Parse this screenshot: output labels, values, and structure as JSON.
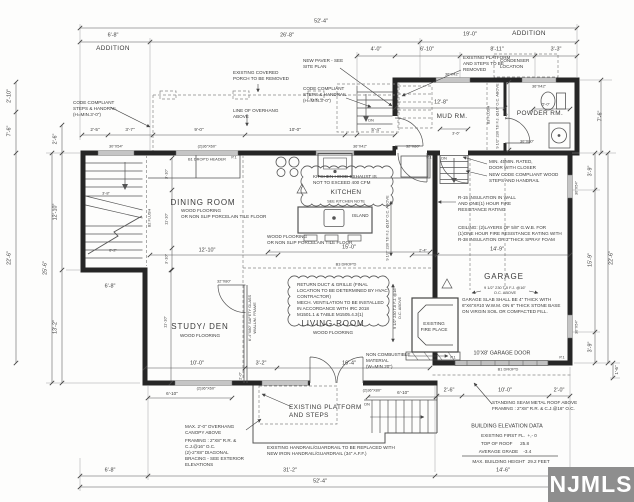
{
  "watermark": {
    "text": "NJMLS"
  },
  "annotations": [
    {
      "n": "dim-overall-top",
      "t": "52'-4\"",
      "x": 321,
      "y": 22,
      "s": 5
    },
    {
      "n": "dim-addition-left-width",
      "t": "6'-8\"",
      "x": 113,
      "y": 36,
      "s": 5
    },
    {
      "n": "label-addition-left",
      "t": "ADDITION",
      "x": 113,
      "y": 49,
      "s": 6
    },
    {
      "n": "dim-main-top",
      "t": "26'-8\"",
      "x": 287,
      "y": 36,
      "s": 5
    },
    {
      "n": "dim-addition-right-width",
      "t": "19'-0\"",
      "x": 470,
      "y": 35,
      "s": 5
    },
    {
      "n": "label-addition-right",
      "t": "ADDITION",
      "x": 529,
      "y": 34,
      "s": 6
    },
    {
      "n": "dim-4-0",
      "t": "4'-0\"",
      "x": 376,
      "y": 50,
      "s": 5
    },
    {
      "n": "dim-6-10-addition",
      "t": "6'-10\"",
      "x": 427,
      "y": 50,
      "s": 5
    },
    {
      "n": "dim-8-11",
      "t": "8'-11\"",
      "x": 497,
      "y": 50,
      "s": 5
    },
    {
      "n": "dim-3-3",
      "t": "3'-3\"",
      "x": 556,
      "y": 50,
      "s": 5
    },
    {
      "n": "note-new-paver",
      "t": "NEW PAVER - SEE\nSITE PLAN",
      "x": 303,
      "y": 58,
      "s": 4,
      "a": "tl"
    },
    {
      "n": "note-platform-steps-removed",
      "t": "EXISTING PLATFORM\nAND STEPS TO BE\nREMOVED",
      "x": 463,
      "y": 55,
      "s": 4,
      "a": "tl"
    },
    {
      "n": "note-condenser-location",
      "t": "CONDENSER\nLOCATION",
      "x": 500,
      "y": 58,
      "s": 4,
      "a": "tl"
    },
    {
      "n": "note-covered-porch-removed",
      "t": "EXISTING COVERED\nPORCH TO BE REMOVED",
      "x": 233,
      "y": 70,
      "s": 4,
      "a": "tl"
    },
    {
      "n": "note-code-steps-top",
      "t": "CODE COMPLIANT\nSTEPS & HANDRAIL\n(H=MIN.3'-0\")",
      "x": 303,
      "y": 86,
      "s": 4,
      "a": "tl"
    },
    {
      "n": "note-line-overhang",
      "t": "LINE OF OVERHANG\nABOVE",
      "x": 233,
      "y": 108,
      "s": 4,
      "a": "tl"
    },
    {
      "n": "note-code-steps-left",
      "t": "CODE COMPLIANT\nSTEPS & HANDRAIL\n(H=MIN.3'-0\")",
      "x": 73,
      "y": 100,
      "s": 4,
      "a": "tl"
    },
    {
      "n": "dim-2-5",
      "t": "2'-5\"",
      "x": 95,
      "y": 130,
      "s": 4
    },
    {
      "n": "dim-3-7",
      "t": "3'-7\"",
      "x": 130,
      "y": 130,
      "s": 4
    },
    {
      "n": "dim-9-0",
      "t": "9'-0\"",
      "x": 199,
      "y": 130,
      "s": 4
    },
    {
      "n": "dim-10-0-porch",
      "t": "10'-0\"",
      "x": 295,
      "y": 130,
      "s": 4
    },
    {
      "n": "dim-5-4",
      "t": "5'-4\"",
      "x": 376,
      "y": 130,
      "s": 4
    },
    {
      "n": "win-30x54-stairs",
      "t": "30\"X54\"",
      "x": 116,
      "y": 146,
      "s": 3
    },
    {
      "n": "win-2-36x60-dining",
      "t": "(2)36\"X60\"",
      "x": 207,
      "y": 146,
      "s": 3
    },
    {
      "n": "hdr-b1-dropd-header",
      "t": "B1 DROP'D HEADER",
      "x": 207,
      "y": 159,
      "s": 3
    },
    {
      "n": "win-36x42-kitchen",
      "t": "36\"X42\"",
      "x": 360,
      "y": 146,
      "s": 3
    },
    {
      "n": "door-32x80-kitchen",
      "t": "32\"X80\"",
      "x": 413,
      "y": 146,
      "s": 3
    },
    {
      "n": "win-36x42-mud",
      "t": "36\"X42\"",
      "x": 452,
      "y": 74,
      "s": 3
    },
    {
      "n": "win-36x42-powder",
      "t": "36\"X42\"",
      "x": 539,
      "y": 86,
      "s": 3
    },
    {
      "n": "dim-5-0-powder",
      "t": "5'-0\"",
      "x": 546,
      "y": 104,
      "s": 3
    },
    {
      "n": "room-powder",
      "t": "POWDER RM.",
      "x": 540,
      "y": 114,
      "s": 6
    },
    {
      "n": "door-30x80-powder",
      "t": "30\"X80\"",
      "x": 527,
      "y": 141,
      "s": 3
    },
    {
      "n": "dim-12-8-mud",
      "t": "12'-8\"",
      "x": 441,
      "y": 103,
      "s": 5
    },
    {
      "n": "room-mud",
      "t": "MUD RM.",
      "x": 452,
      "y": 117,
      "s": 6
    },
    {
      "n": "dim-7-6-addition-right",
      "t": "7'-6\"",
      "x": 601,
      "y": 116,
      "s": 5,
      "r": 1
    },
    {
      "n": "dim-3-6-mud-stairs",
      "t": "3'-6\"",
      "x": 456,
      "y": 133,
      "s": 3
    },
    {
      "n": "note-b3-flush",
      "t": "B3 FLUSH",
      "x": 488,
      "y": 115,
      "s": 3,
      "r": 1
    },
    {
      "n": "note-tji-mud",
      "t": "9 1/2\" 230 TJI F.J. @16\" O.C. ABOVE",
      "x": 497,
      "y": 116,
      "s": 3,
      "r": 1
    },
    {
      "n": "dim-7-0-powder",
      "t": "7'-0\"",
      "x": 506,
      "y": 116,
      "s": 3,
      "r": 1
    },
    {
      "n": "dn-mud-stairs",
      "t": "DN",
      "x": 444,
      "y": 158,
      "s": 3
    },
    {
      "n": "room-dining",
      "t": "DINING ROOM",
      "x": 203,
      "y": 203,
      "s": 7
    },
    {
      "n": "floor-dining",
      "t": "WOOD FLOORING\nOR NON SLIP PORCELAIN TILE FLOOR",
      "x": 181,
      "y": 208,
      "s": 4,
      "a": "tl"
    },
    {
      "n": "dim-3-10-a",
      "t": "3'-10\"",
      "x": 166,
      "y": 174,
      "s": 3,
      "r": 1
    },
    {
      "n": "dim-11-10-dining",
      "t": "11'-10\"",
      "x": 166,
      "y": 219,
      "s": 3,
      "r": 1
    },
    {
      "n": "dim-3-10-b",
      "t": "3'-10\"",
      "x": 166,
      "y": 259,
      "s": 3,
      "r": 1
    },
    {
      "n": "dim-3-8-stairs",
      "t": "3'-8\"",
      "x": 106,
      "y": 193,
      "s": 3
    },
    {
      "n": "dim-6-2-stairs",
      "t": "6'-2\"",
      "x": 113,
      "y": 250,
      "s": 3
    },
    {
      "n": "dim-6-8-stairs",
      "t": "6'-8\"",
      "x": 110,
      "y": 287,
      "s": 5
    },
    {
      "n": "dim-12-10-stairhall",
      "t": "12'-10\"",
      "x": 56,
      "y": 212,
      "s": 5,
      "r": 1
    },
    {
      "n": "dim-25-6-left",
      "t": "25'-6\"",
      "x": 46,
      "y": 268,
      "s": 5,
      "r": 1
    },
    {
      "n": "dim-13-2-left",
      "t": "13'-2\"",
      "x": 56,
      "y": 327,
      "s": 5,
      "r": 1
    },
    {
      "n": "dim-22-6-left",
      "t": "22'-6\"",
      "x": 10,
      "y": 258,
      "s": 5,
      "r": 1
    },
    {
      "n": "dim-2-10-left",
      "t": "2'-10\"",
      "x": 10,
      "y": 96,
      "s": 5,
      "r": 1
    },
    {
      "n": "dim-7-6-left",
      "t": "7'-6\"",
      "x": 10,
      "y": 131,
      "s": 5,
      "r": 1
    },
    {
      "n": "dim-2-6-left",
      "t": "2'-6\"",
      "x": 56,
      "y": 139,
      "s": 5,
      "r": 1
    },
    {
      "n": "note-b2-flush",
      "t": "B2 FLUSH",
      "x": 149,
      "y": 218,
      "s": 3,
      "r": 1
    },
    {
      "n": "cloud-kitchen-hood",
      "t": "KITCHEN HOOD EXHAUST IS\nNOT TO EXCEED 400 CFM",
      "x": 313,
      "y": 174,
      "s": 4,
      "a": "tl"
    },
    {
      "n": "room-kitchen",
      "t": "KITCHEN",
      "x": 346,
      "y": 193,
      "s": 6
    },
    {
      "n": "note-see-kitchen",
      "t": "SEE KITCHEN NOTE",
      "x": 346,
      "y": 201,
      "s": 3
    },
    {
      "n": "label-island",
      "t": "ISLAND",
      "x": 352,
      "y": 216,
      "s": 4,
      "a": "lm"
    },
    {
      "n": "floor-kitchen",
      "t": "WOOD FLOORING\nOR NON SLIP PORCELAIN TILE FLOOR",
      "x": 267,
      "y": 234,
      "s": 4,
      "a": "tl"
    },
    {
      "n": "dim-15-0-kitchen",
      "t": "15'-0\"",
      "x": 349,
      "y": 248,
      "s": 5
    },
    {
      "n": "note-b3-dropd",
      "t": "B3 DROP'D",
      "x": 346,
      "y": 264,
      "s": 3
    },
    {
      "n": "note-tji-kitchen",
      "t": "9 1/2\" 230 TJI F.J. @16\" O.C. ABOVE",
      "x": 387,
      "y": 228,
      "s": 3,
      "r": 1
    },
    {
      "n": "dim-2-4",
      "t": "2'-4\"",
      "x": 423,
      "y": 250,
      "s": 3
    },
    {
      "n": "note-rated-door",
      "t": "MIN. 45MIN. RATED,\nDOOR WITH CLOSER",
      "x": 489,
      "y": 159,
      "s": 4,
      "a": "tl"
    },
    {
      "n": "note-new-wood-steps",
      "t": "NEW CODE COMPLIANT WOOD\nSTEPS AND HANDRAIL",
      "x": 489,
      "y": 172,
      "s": 4,
      "a": "tl"
    },
    {
      "n": "note-r15",
      "t": "R-15 INSULATION IN WALL\nAND ONE(1) HOUR FIRE\nRESISTANCE RATING",
      "x": 458,
      "y": 195,
      "s": 4,
      "a": "tl"
    },
    {
      "n": "note-garage-ceiling",
      "t": "CEILING: (2)LAYERS OF 5/8\" G.W.B. FOR\n(1)ONE HOUR FIRE RESISTANCE RATING WITH\nR-38 INSULATION OR 3\"THICK SPRAY FOAM",
      "x": 458,
      "y": 225,
      "s": 4,
      "a": "tl"
    },
    {
      "n": "dim-14-9-garage",
      "t": "14'-9\"",
      "x": 497,
      "y": 250,
      "s": 5
    },
    {
      "n": "room-garage",
      "t": "GARAGE",
      "x": 504,
      "y": 277,
      "s": 7
    },
    {
      "n": "note-tji-garage",
      "t": "9 1/2\" 230 TJI F.J. @16\"\nO.C. ABOVE",
      "x": 505,
      "y": 290,
      "s": 3
    },
    {
      "n": "note-garage-slab",
      "t": "GARAGE SLAB SHALL BE 4\" THICK WITH\n6\"X6\"X#10 W.W.M. ON 6\" THICK STONE BASE\nON VIRGIN SOIL OR COMPACTED FILL.",
      "x": 462,
      "y": 297,
      "s": 4,
      "a": "tl"
    },
    {
      "n": "label-garage-door",
      "t": "10'X8' GARAGE DOOR",
      "x": 502,
      "y": 354,
      "s": 5
    },
    {
      "n": "note-b1-dropd-garage",
      "t": "B1 DROP'D",
      "x": 508,
      "y": 369,
      "s": 3
    },
    {
      "n": "dim-2-6-garage",
      "t": "2'-6\"",
      "x": 449,
      "y": 391,
      "s": 5
    },
    {
      "n": "dim-10-0-garage",
      "t": "10'-0\"",
      "x": 505,
      "y": 391,
      "s": 5
    },
    {
      "n": "dim-2-0-garage",
      "t": "2'-0\"",
      "x": 559,
      "y": 391,
      "s": 5
    },
    {
      "n": "dim-3-9-a",
      "t": "3'-9\"",
      "x": 591,
      "y": 171,
      "s": 5,
      "r": 1
    },
    {
      "n": "dim-15-9-right",
      "t": "15'-9\"",
      "x": 591,
      "y": 260,
      "s": 5,
      "r": 1
    },
    {
      "n": "dim-3-9-b",
      "t": "3'-9\"",
      "x": 591,
      "y": 347,
      "s": 5,
      "r": 1
    },
    {
      "n": "dim-22-6-right",
      "t": "22'-6\"",
      "x": 612,
      "y": 258,
      "s": 5,
      "r": 1
    },
    {
      "n": "dim-1-6-right",
      "t": "1'-6\"",
      "x": 617,
      "y": 370,
      "s": 4,
      "r": 1
    },
    {
      "n": "win-30x54-garage-a",
      "t": "30\"X54\"",
      "x": 576,
      "y": 188,
      "s": 3,
      "r": 1
    },
    {
      "n": "win-30x54-garage-b",
      "t": "30\"X54\"",
      "x": 576,
      "y": 327,
      "s": 3,
      "r": 1
    },
    {
      "n": "cloud-return-duct",
      "t": "RETURN DUCT & GRILLE (FINAL\nLOCATION TO BE DETERMINED BY HVAC\nCONTRACTOR)\nMECH. VENTILATION TO BE INSTALLED\nIN ACCORDANCE WITH IRC 2018\nM1501.1 & TABLE M1505.4.3(1)",
      "x": 297,
      "y": 282,
      "s": 4,
      "a": "tl"
    },
    {
      "n": "room-living",
      "t": "LIVING ROOM",
      "x": 333,
      "y": 324,
      "s": 7
    },
    {
      "n": "floor-living",
      "t": "WOOD FLOORING",
      "x": 333,
      "y": 333,
      "s": 4
    },
    {
      "n": "room-study",
      "t": "STUDY/ DEN",
      "x": 200,
      "y": 327,
      "s": 7
    },
    {
      "n": "floor-study",
      "t": "WOOD FLOORING",
      "x": 200,
      "y": 336,
      "s": 4
    },
    {
      "n": "dim-11-10-study",
      "t": "11'-10\"",
      "x": 165,
      "y": 322,
      "s": 3,
      "r": 1
    },
    {
      "n": "note-safety-glass",
      "t": "6'-4\"X80\" SAFETY GLASS\nW/ALUM. FRAME",
      "x": 252,
      "y": 318,
      "s": 3,
      "r": 1
    },
    {
      "n": "door-32x80-study",
      "t": "32\"X80\"",
      "x": 224,
      "y": 281,
      "s": 3
    },
    {
      "n": "dim-10-0-study",
      "t": "10'-0\"",
      "x": 197,
      "y": 364,
      "s": 5
    },
    {
      "n": "dim-3-2-study",
      "t": "3'-2\"",
      "x": 261,
      "y": 364,
      "s": 5
    },
    {
      "n": "dim-2-0-study",
      "t": "2'-0\"",
      "x": 240,
      "y": 376,
      "s": 3,
      "r": 1
    },
    {
      "n": "label-fireplace",
      "t": "EXISTING\nFIRE PLACE",
      "x": 434,
      "y": 327,
      "s": 4
    },
    {
      "n": "note-noncombustible",
      "t": "NON COMBUSTIBLE\nMATERIAL\n(W=MIN.20\")",
      "x": 366,
      "y": 352,
      "s": 4,
      "a": "tl"
    },
    {
      "n": "dim-16-4-living",
      "t": "16'-4\"",
      "x": 349,
      "y": 364,
      "s": 5
    },
    {
      "n": "note-tji-living",
      "t": "9 1/2\" 230 TJI F.J. @16\"\nO.C. ABOVE",
      "x": 397,
      "y": 308,
      "s": 3,
      "r": 1
    },
    {
      "n": "door-2-36x80-front",
      "t": "(2)36\"X80\"",
      "x": 372,
      "y": 390,
      "s": 3
    },
    {
      "n": "dim-6-10-front",
      "t": "6'-10\"",
      "x": 403,
      "y": 393,
      "s": 4
    },
    {
      "n": "dn-front-steps",
      "t": "DN",
      "x": 367,
      "y": 404,
      "s": 3
    },
    {
      "n": "note-platform-steps",
      "t": "EXISTING PLATFORM\nAND STEPS",
      "x": 289,
      "y": 404,
      "s": 6,
      "a": "tl"
    },
    {
      "n": "note-handrail",
      "t": "EXISTING HANDRAIL/GUARDRAIL TO BE REPLACED WITH\nNEW IRON HANDRAIL/GUARDRAIL (34\" A.F.F.)",
      "x": 267,
      "y": 445,
      "s": 4,
      "a": "tl"
    },
    {
      "n": "note-canopy",
      "t": "MAX. 2'-0\" OVERHANG\nCANOPY ABOVE",
      "x": 185,
      "y": 424,
      "s": 4,
      "a": "tl"
    },
    {
      "n": "note-framing",
      "t": "FRAMING : 2\"X8\" R.R. &\nC.J.@16\" O.C.\n(2)-2\"X8\" DIAGONAL\nBRACING - SEE EXTERIOR\nELEVATIONS",
      "x": 185,
      "y": 438,
      "s": 4,
      "a": "tl"
    },
    {
      "n": "note-standing-seam",
      "t": "STANDING SEAM METAL ROOF ABOVE\nFRAMING : 2\"X8\" R.R. & C.J.@16\" O.C.",
      "x": 492,
      "y": 400,
      "s": 4,
      "a": "tl"
    },
    {
      "n": "elev-title",
      "t": "BUILDING ELEVATION DATA",
      "x": 507,
      "y": 427,
      "s": 5
    },
    {
      "n": "elev-first-fl",
      "t": "EXISTING FIRST FL.  +,- 0",
      "x": 509,
      "y": 436,
      "s": 4
    },
    {
      "n": "elev-top-roof",
      "t": "TOP OF ROOF      25.8",
      "x": 505,
      "y": 444,
      "s": 4
    },
    {
      "n": "elev-avg-grade",
      "t": "AVERAGE GRADE    -3.4",
      "x": 505,
      "y": 452,
      "s": 4
    },
    {
      "n": "elev-max-height",
      "t": "MAX. BUILDING HEIGHT  29.2 FEET",
      "x": 511,
      "y": 462,
      "s": 4
    },
    {
      "n": "dim-14-6-bottom",
      "t": "14'-6\"",
      "x": 503,
      "y": 471,
      "s": 5
    },
    {
      "n": "dim-6-8-bottom",
      "t": "6'-8\"",
      "x": 110,
      "y": 471,
      "s": 5
    },
    {
      "n": "dim-31-2-bottom",
      "t": "31'-2\"",
      "x": 290,
      "y": 471,
      "s": 5
    },
    {
      "n": "dim-52-4-bottom",
      "t": "52'-4\"",
      "x": 320,
      "y": 482,
      "s": 5
    },
    {
      "n": "win-2-36x60-study",
      "t": "(2)36\"X60\"",
      "x": 206,
      "y": 388,
      "s": 3
    },
    {
      "n": "dim-6-10-study",
      "t": "6'-10\"",
      "x": 172,
      "y": 394,
      "s": 4
    },
    {
      "n": "dn-exterior-top",
      "t": "DN",
      "x": 371,
      "y": 120,
      "s": 3
    },
    {
      "n": "post-p1-a",
      "t": "P.1",
      "x": 234,
      "y": 157,
      "s": 3
    },
    {
      "n": "post-p1-b",
      "t": "P.1",
      "x": 429,
      "y": 157,
      "s": 3
    },
    {
      "n": "post-p1-c",
      "t": "P.1",
      "x": 453,
      "y": 357,
      "s": 3
    },
    {
      "n": "post-p1-d",
      "t": "P.1",
      "x": 562,
      "y": 357,
      "s": 3
    },
    {
      "n": "dim-12-10-dining",
      "t": "12'-10\"",
      "x": 207,
      "y": 251,
      "s": 5
    }
  ]
}
